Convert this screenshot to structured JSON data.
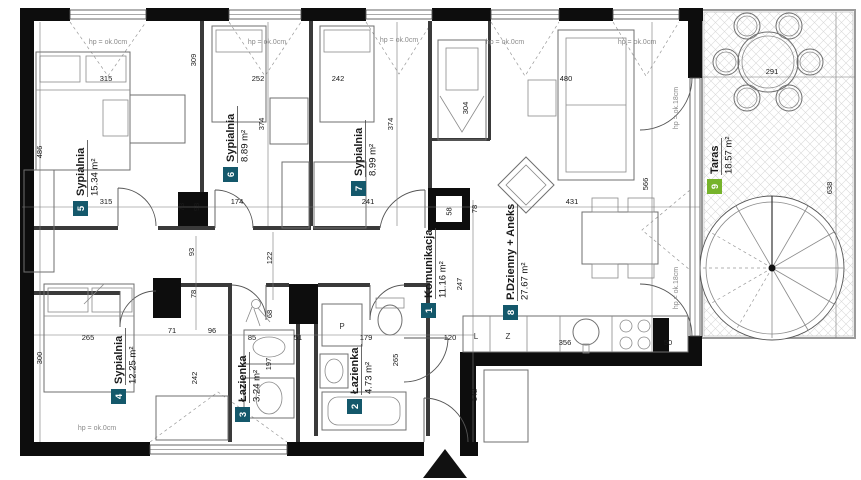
{
  "plan": {
    "type": "apartment-floor-plan",
    "colors": {
      "badge_teal": "#14586B",
      "badge_green": "#76B32B",
      "wall": "#0D0D0D"
    },
    "rooms": [
      {
        "num": "1",
        "name": "Komunikacja",
        "area": "11.16 m²"
      },
      {
        "num": "2",
        "name": "Łazienka",
        "area": "4.73 m²"
      },
      {
        "num": "3",
        "name": "Łazienka",
        "area": "3.24 m²"
      },
      {
        "num": "4",
        "name": "Sypialnia",
        "area": "12.25 m²"
      },
      {
        "num": "5",
        "name": "Sypialnia",
        "area": "15.34 m²"
      },
      {
        "num": "6",
        "name": "Sypialnia",
        "area": "8.89 m²"
      },
      {
        "num": "7",
        "name": "Sypialnia",
        "area": "8.99 m²"
      },
      {
        "num": "8",
        "name": "P.Dzienny + Aneks",
        "area": "27.67 m²"
      },
      {
        "num": "9",
        "name": "Taras",
        "area": "18.57 m²"
      }
    ],
    "annotations": {
      "sill_zero": "hp = ok.0cm",
      "sill_18": "hp = ok.18cm",
      "washer": "P",
      "fridge": "L",
      "dishwasher": "Z"
    },
    "dims": [
      "315",
      "309",
      "252",
      "242",
      "480",
      "374",
      "374",
      "304",
      "566",
      "486",
      "300",
      "315",
      "73",
      "98",
      "174",
      "241",
      "58",
      "78",
      "431",
      "247",
      "93",
      "122",
      "78",
      "68",
      "96",
      "71",
      "85",
      "51",
      "265",
      "242",
      "197",
      "179",
      "265",
      "120",
      "142",
      "356",
      "50",
      "638",
      "291"
    ]
  }
}
